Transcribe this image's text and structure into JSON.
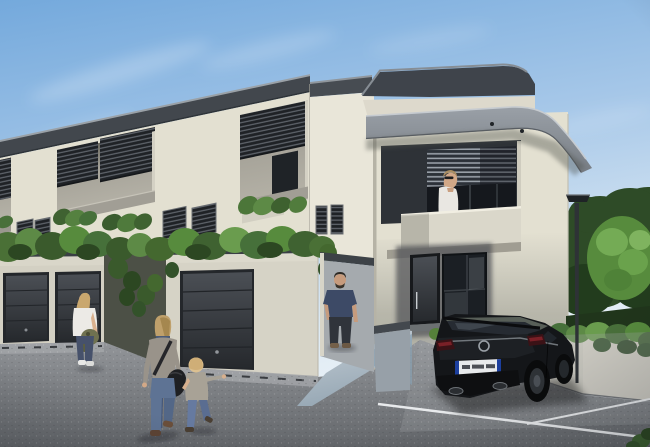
{
  "scene": {
    "title": "New-build terraced houses - exterior visualization",
    "setting": "Photorealistic daytime rendering of a modern two-storey terraced housing block with louvred loggia screens, planted garage roofs, a curved grey entrance canopy, a paved entrance ramp, parking bays with a black hatchback, street lamp, boundary wall with ivy, trees, and five people",
    "time_of_day": "daytime, clear blue sky with faint cloud wisps",
    "style": "3D architectural visualization"
  },
  "visible_text": {
    "note": "No legible text anywhere in the image; the car licence plate is EU-style (blue side bands) with illegible characters"
  },
  "building": {
    "storeys": 2,
    "facade_finish": "warm cream render",
    "roof": "flat roof with dark grey fascia band",
    "loggia_bays_visible": 4,
    "loggia_screens": "dark horizontal aluminium louvres",
    "ventilation_grilles": "three pairs of small louvred grilles",
    "garage_doors_visible": 3,
    "garage_roofs": "planted with shrubs and trailing vines",
    "front_unit_features": [
      "curved grey canopy with recessed spotlights",
      "recessed balcony with blinds",
      "dark entrance door with long handle",
      "full-height stair glazing"
    ]
  },
  "people": [
    {
      "id": "woman-by-garage",
      "description": "blonde woman, white t-shirt, dark jeans, white sneakers, holding an olive jacket, standing in profile by the left garages"
    },
    {
      "id": "mother-walking",
      "description": "blonde woman seen from behind, grey top, blue jeans, black shoulder bag, walking and holding a child's hand"
    },
    {
      "id": "child-walking",
      "description": "small blond child, beige-grey top, jeans, arm stretched out, walking beside the woman"
    },
    {
      "id": "man-on-path",
      "description": "bearded man, navy t-shirt, dark jeans, standing on the paved entrance ramp"
    },
    {
      "id": "woman-at-window",
      "description": "woman with sunglasses and white blouse standing at the first-floor balcony window"
    }
  ],
  "vehicle": {
    "type": "black 5-door hatchback (VW Golf-like)",
    "state": "parked in marked bay, rear three-quarter view",
    "licence_plate": "white EU plate, blue bands both ends, illegible characters",
    "details": [
      "dual exhaust tips",
      "dark alloy wheels",
      "roundel badge on hatch"
    ]
  },
  "vegetation": {
    "right_side": "large bright-green tree over darker trees and a dark hedge behind a boundary wall topped with trailing ivy",
    "on_building": "shrub hedges on garage roofs, hanging vines between garage volumes, planters at loggia sills"
  },
  "ground": {
    "surface": "grey asphalt with light speckle",
    "markings": "two white parking bay lines",
    "walkway": "light blue-grey paved ramp with low grey flanking walls",
    "details": "lighter concrete aprons with drainage slots in front of garage doors"
  },
  "street_furniture": {
    "lamp": "dark flat-top street lamp on slim pole by the boundary wall"
  },
  "palette": {
    "sky_top": "#7aaede",
    "sky_horizon": "#e3edf5",
    "facade": "#e3e0d1",
    "facade_shadow": "#b9b6a9",
    "fascia_dark": "#42474d",
    "canopy_grey": "#8d939a",
    "louvre_dark": "#26292e",
    "garage_door": "#35393e",
    "foliage_light": "#6fa450",
    "foliage_dark": "#2e4b27",
    "asphalt": "#85888c",
    "paver": "#b9c5cd",
    "parking_line": "#e8eaec",
    "car_body": "#141619",
    "jeans_blue": "#5e7394"
  }
}
